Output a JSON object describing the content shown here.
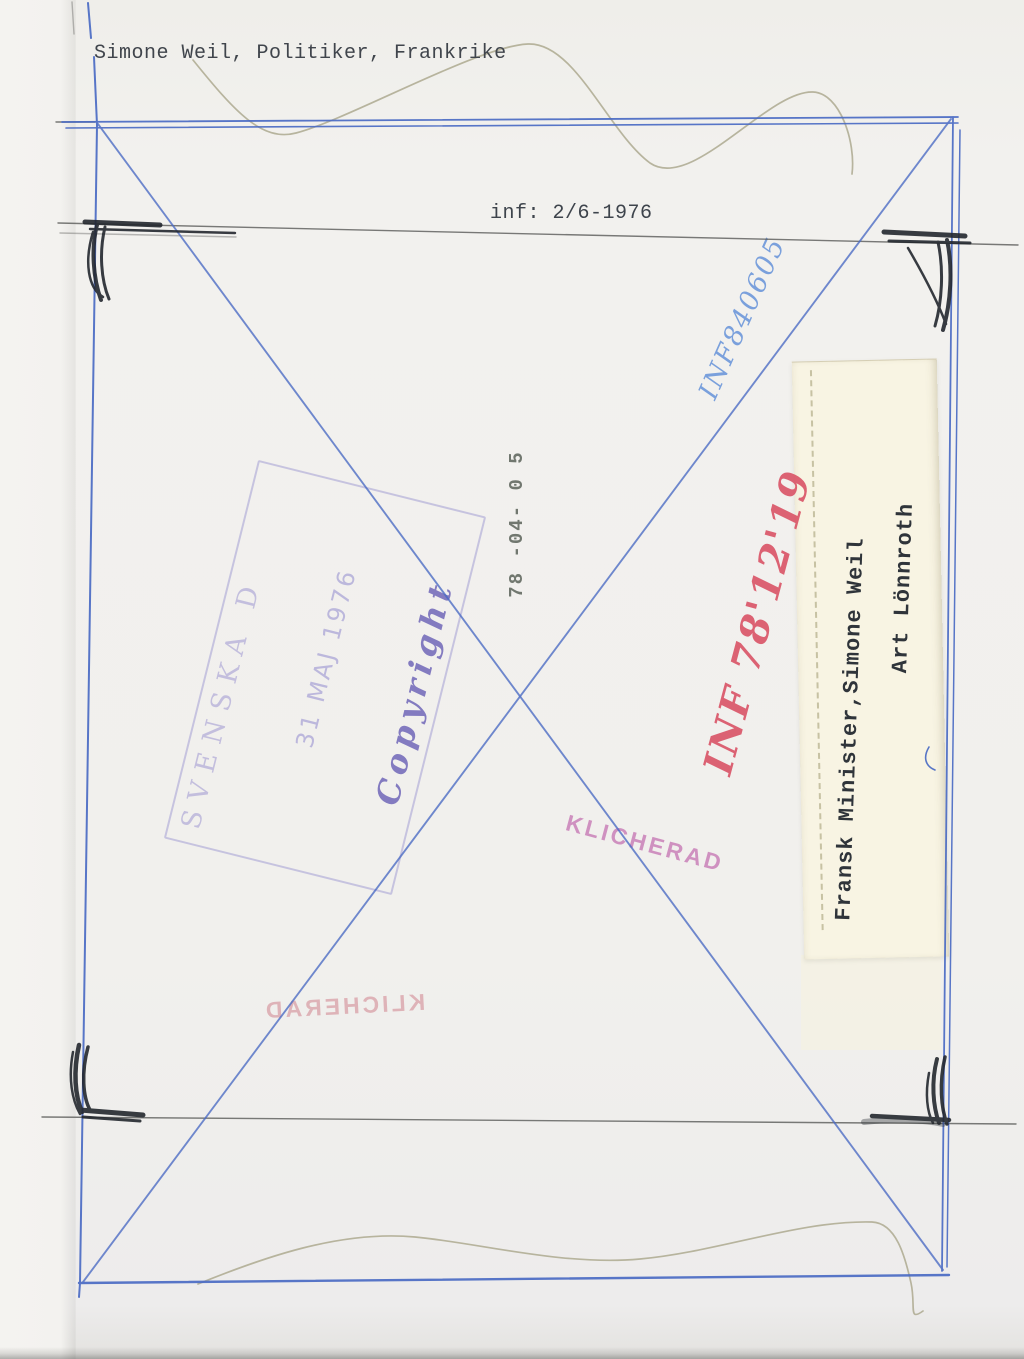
{
  "typed": {
    "caption": "Simone Weil, Politiker, Frankrike",
    "inf_line": "inf: 2/6-1976"
  },
  "handwritten": {
    "blue_number": "INF840605",
    "red_number": "INF 78'12'19"
  },
  "stamps": {
    "date_stamp": "78 -04- 0 5",
    "klicherad": "KLICHERAD",
    "klicherad_mirrored": "KLICHERAD",
    "copyright_box": {
      "line_org": "SVENSKA D",
      "line_date": "31 MAJ 1976",
      "line_copyright": "Copyright"
    }
  },
  "label": {
    "line1": "Fransk Minister,Simone Weil",
    "line2": "Art Lönnroth"
  },
  "colors": {
    "blue_pen": "#4a6bc4",
    "light_blue_pen": "#7aa0dc",
    "red_pen": "#d94f63",
    "pink_stamp": "#c77bb6",
    "purple_stamp": "#7b6fc0",
    "black_ink": "#23272e",
    "pencil": "#595a58",
    "squiggle": "#b0ad95",
    "paper": "#f1f0ed",
    "label_paper": "#f8f4e3"
  }
}
